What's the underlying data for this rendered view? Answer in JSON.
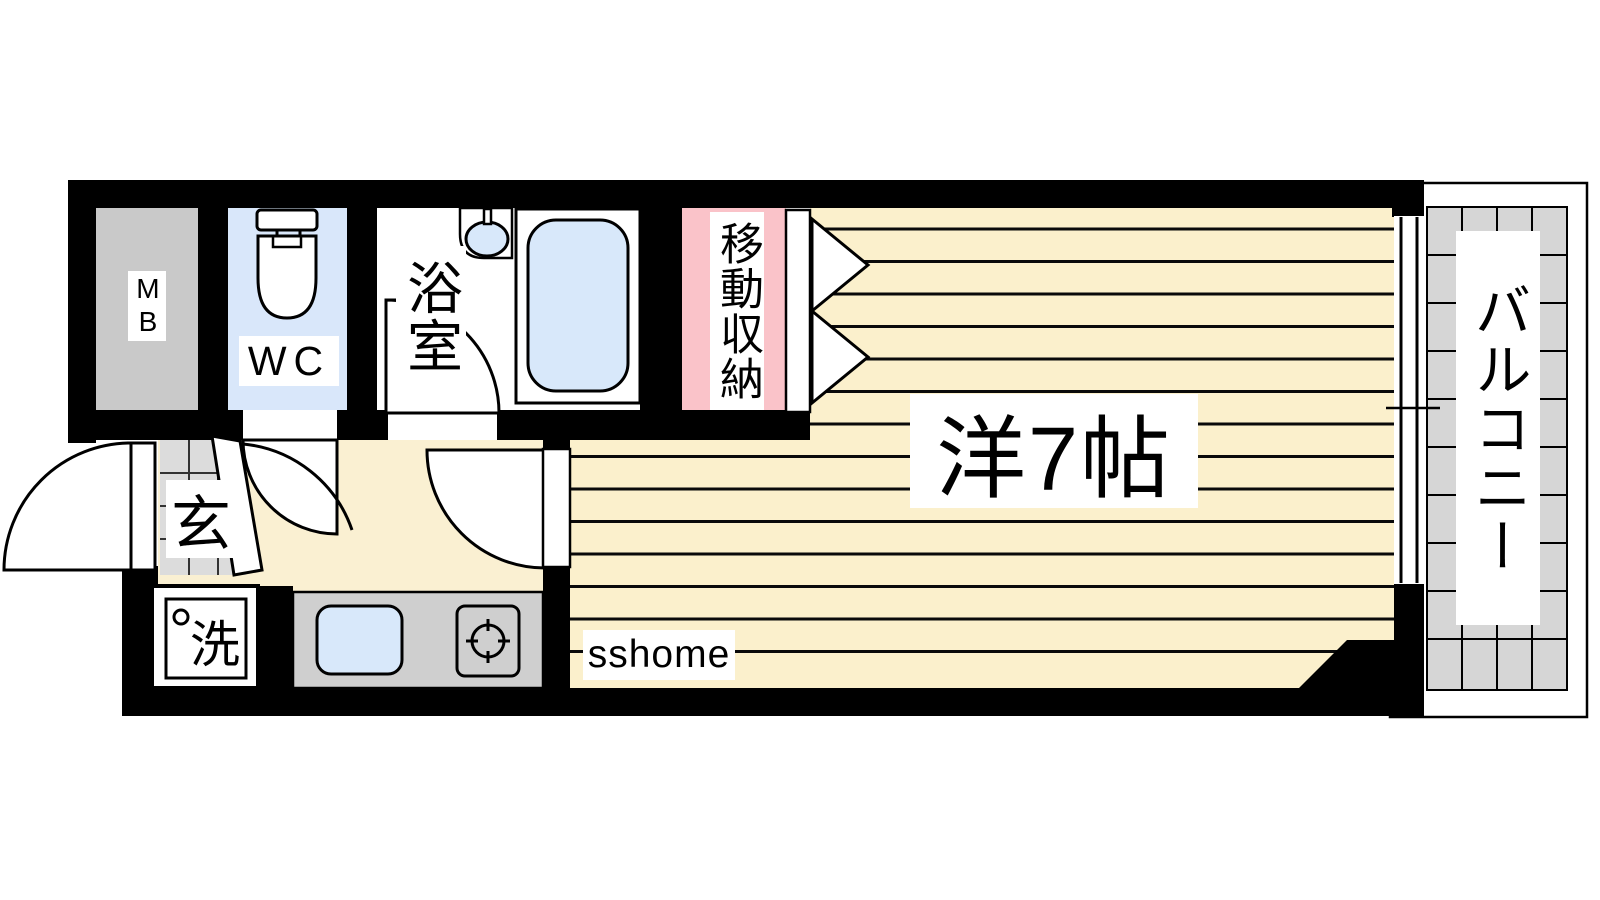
{
  "document": {
    "type": "apartment-floor-plan",
    "watermark": "sshome"
  },
  "rooms": {
    "meter_box": {
      "label": "MB"
    },
    "toilet": {
      "label": "WC"
    },
    "bathroom": {
      "label": "浴室"
    },
    "closet": {
      "label": "移動収納"
    },
    "main_room": {
      "label": "洋7帖",
      "tatami_count": 7
    },
    "entrance": {
      "label": "玄"
    },
    "laundry": {
      "label": "洗"
    },
    "balcony": {
      "label": "バルコニー"
    }
  },
  "colors": {
    "wall": "#000000",
    "room_floor": "#FBF0CC",
    "hallway_floor": "#FAF0D2",
    "closet_pink": "#FAC3C9",
    "water_blue": "#D8E8FA",
    "wc_floor": "#D9E7FA",
    "meter_box_gray": "#C9C9C9",
    "kitchen_gray": "#CFCFCF",
    "balcony_tile_gray": "#D6D6D6",
    "genkan_tile_gray": "#DCDCDC",
    "stripe": "#0A0A0A"
  }
}
